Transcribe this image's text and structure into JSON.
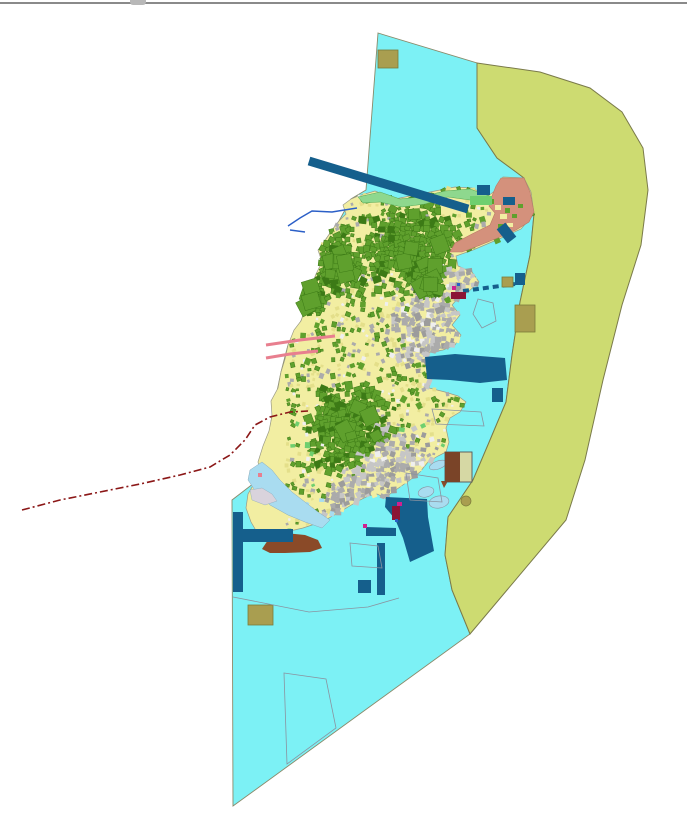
{
  "meta": {
    "title": "island-land-use-planning-map",
    "width": 687,
    "height": 821
  },
  "chrome": {
    "top_border_color": "#8a8a8a",
    "notch": {
      "x": 130,
      "w": 16,
      "color": "#b8b8b8"
    }
  },
  "palette": {
    "sea": "#7CF1F5",
    "sea_stroke": "#8a8a6a",
    "coastal_band": "#CDDB71",
    "band_stroke": "#7a7a4a",
    "island_base": "#F2EEA2",
    "island_stroke": "#9a9a86",
    "green": "#5FA02D",
    "green_dark": "#3C7A16",
    "green_light": "#6FCF6F",
    "beach": "#8ED88E",
    "beach_stroke": "#55A855",
    "urban": "#ABABAB",
    "urban_light": "#C6C6C6",
    "urban_dark": "#9C9C9C",
    "salmon": "#D4917C",
    "salmon_stroke": "#b97a64",
    "navy": "#155F8C",
    "khaki": "#A99E50",
    "khaki_stroke": "#7a7a3a",
    "brown": "#8A4A28",
    "pale_blue": "#A9DCF0",
    "pale_blue_stroke": "#88AABB",
    "pale_gray": "#D9D3DC",
    "outline": "#8A93A0",
    "boundary_red": "#8B1717",
    "pink": "#E87F8F",
    "stream_blue": "#2B5FC7",
    "magenta": "#D02090",
    "crimson": "#8B1535",
    "white_speck": "#EFEFEF",
    "yellow_deep": "#E4DF8A"
  },
  "geometry": {
    "sea": "378,33 477,63 477,128 497,158 516,172 524,178 534,214 530,255 520,302 512,355 506,402 490,440 473,480 448,517 445,555 452,590 461,612 470,634 233,806 232,500 262,477 272,416 281,372 288,345 301,321 305,310 311,287 322,262 326,239 339,221 351,199 366,190",
    "coastal_band": "477,63 540,72 590,88 622,112 643,148 648,190 641,245 622,305 603,380 585,460 566,520 470,634 461,612 452,590 445,555 448,517 473,480 490,440 506,402 512,355 520,302 530,255 534,214 524,178 516,172 497,158 477,128",
    "island": "358,196 375,191 395,199 415,195 435,191 455,187 472,188 488,196 496,190 503,177 524,178 531,192 534,214 521,229 499,239 473,250 456,256 458,266 472,272 479,282 468,292 459,297 452,305 460,315 452,325 461,335 455,345 443,350 430,352 427,362 432,375 429,388 445,392 458,396 466,402 460,412 450,418 446,428 449,442 446,452 438,456 428,462 420,472 410,480 400,487 390,494 386,498 377,494 368,496 358,501 348,507 338,513 327,519 315,524 303,528 290,531 277,534 266,540 258,534 251,522 246,508 248,494 255,482 262,477 258,462 263,446 269,431 272,416 271,401 278,388 281,372 285,359 288,345 294,330 301,321 305,310 303,295 311,287 316,274 322,262 318,250 326,239 332,230 339,221 346,214 343,205 351,199",
    "beach_strip": "358,197 380,192 400,199 420,197 445,191 470,189 492,197 488,203 470,200 448,197 425,204 402,207 380,202 363,203",
    "reclamation": "501,178 524,178 530,192 534,212 529,222 516,230 500,237 478,246 462,252 450,252 455,243 472,234 490,225 495,213 489,206 492,196 496,186",
    "harbor": "425,357 455,354 480,356 505,358 507,380 480,383 450,380 427,379",
    "pier_south": "386,497 427,499 428,517 434,551 410,562 403,538 395,519 385,507",
    "small_navy_bar": "366,527 396,528 396,536 366,536",
    "brown_blob": "262,549 270,537 285,533 305,535 318,540 322,548 310,552 285,553 270,553",
    "brown_triangle": "441,481 448,481 444,488",
    "lagoon": "250,470 262,462 272,470 280,480 292,492 305,502 318,512 330,520 322,528 305,522 288,515 270,505 256,492 248,480",
    "pale_gray_blob": "250,490 262,488 272,494 277,501 265,505 252,500",
    "outline_shapes": [
      {
        "name": "anchorage-pentagon",
        "points": "478,299 493,303 496,321 482,328 473,314"
      },
      {
        "name": "anchorage-quad-east",
        "points": "432,409 481,412 484,426 436,424"
      },
      {
        "name": "anchorage-quad-southeast",
        "points": "406,473 438,478 442,502 410,500"
      },
      {
        "name": "anchorage-quad-southwest",
        "points": "350,543 378,546 382,568 352,566"
      },
      {
        "name": "anchorage-quad-south",
        "points": "284,673 326,679 336,728 287,764"
      }
    ],
    "south_zone_polyline": "233,597 309,612 368,607 399,598",
    "zone_rects": [
      {
        "name": "zone-rect-north-khaki",
        "x": 378,
        "y": 50,
        "w": 20,
        "h": 18,
        "fill": "khaki",
        "stroke": "khaki_stroke"
      },
      {
        "name": "zone-rect-navy-north",
        "x": 477,
        "y": 185,
        "w": 13,
        "h": 10,
        "fill": "navy"
      },
      {
        "name": "zone-rect-green-north",
        "x": 470,
        "y": 196,
        "w": 22,
        "h": 9,
        "fill": "green_light"
      },
      {
        "name": "zone-blob-navy-salmon",
        "x": 503,
        "y": 197,
        "w": 12,
        "h": 8,
        "fill": "navy"
      },
      {
        "name": "zone-rect-khaki-east-small",
        "x": 502,
        "y": 277,
        "w": 11,
        "h": 10,
        "fill": "khaki",
        "stroke": "khaki_stroke"
      },
      {
        "name": "zone-rect-navy-east-small",
        "x": 515,
        "y": 273,
        "w": 10,
        "h": 12,
        "fill": "navy"
      },
      {
        "name": "zone-rect-khaki-east-large",
        "x": 515,
        "y": 305,
        "w": 20,
        "h": 27,
        "fill": "khaki",
        "stroke": "khaki_stroke"
      },
      {
        "name": "zone-rect-navy-southeast",
        "x": 492,
        "y": 388,
        "w": 11,
        "h": 14,
        "fill": "navy"
      },
      {
        "name": "zone-rect-navy-pier-bar",
        "x": 377,
        "y": 543,
        "w": 8,
        "h": 52,
        "fill": "navy"
      },
      {
        "name": "zone-rect-navy-south-square",
        "x": 358,
        "y": 580,
        "w": 13,
        "h": 13,
        "fill": "navy"
      },
      {
        "name": "zone-rect-navy-west-bar",
        "x": 233,
        "y": 512,
        "w": 10,
        "h": 80,
        "fill": "navy"
      },
      {
        "name": "zone-rect-navy-west-arm",
        "x": 243,
        "y": 529,
        "w": 50,
        "h": 13,
        "fill": "navy"
      },
      {
        "name": "zone-rect-khaki-southwest",
        "x": 248,
        "y": 605,
        "w": 25,
        "h": 20,
        "fill": "khaki",
        "stroke": "khaki_stroke"
      }
    ],
    "bordered_rect": {
      "x": 445,
      "y": 452,
      "w": 27,
      "h": 30,
      "left_w": 15
    },
    "khaki_circle": {
      "cx": 466,
      "cy": 501,
      "r": 5
    },
    "islets": [
      {
        "cx": 426,
        "cy": 492,
        "rx": 8,
        "ry": 5,
        "rot": -15
      },
      {
        "cx": 439,
        "cy": 502,
        "rx": 10,
        "ry": 6,
        "rot": -10
      },
      {
        "cx": 438,
        "cy": 465,
        "rx": 9,
        "ry": 4,
        "rot": -20
      }
    ],
    "lines": {
      "breakwater_main": {
        "x1": 309,
        "y1": 161,
        "x2": 468,
        "y2": 209,
        "w": 9
      },
      "breakwater_short": {
        "x1": 501,
        "y1": 226,
        "x2": 512,
        "y2": 240,
        "w": 11
      },
      "breakwater_dashes": {
        "x1": 463,
        "y1": 291,
        "x2": 515,
        "y2": 284,
        "w": 4,
        "dash": "6 4"
      },
      "pink_piers": [
        {
          "points": "266,345 300,340 335,336",
          "w": 3
        },
        {
          "points": "266,358 290,354 318,351",
          "w": 3
        }
      ],
      "streams": [
        {
          "points": "357,208 332,212 312,211 300,218 288,226",
          "w": 1.4
        },
        {
          "points": "290,230 305,232",
          "w": 1.4
        }
      ],
      "boundary_dashed": {
        "points": "22,510 60,500 100,492 140,484 180,475 210,467 230,455 245,440 255,425 270,417 290,412 308,411",
        "w": 1.6,
        "dash": "8 3 2 3"
      }
    },
    "micro_marks": [
      {
        "x": 392,
        "y": 506,
        "w": 8,
        "h": 14,
        "fill": "crimson"
      },
      {
        "x": 397,
        "y": 502,
        "w": 5,
        "h": 4,
        "fill": "magenta"
      },
      {
        "x": 395,
        "y": 519,
        "w": 3,
        "h": 3,
        "fill": "stream_blue"
      },
      {
        "x": 363,
        "y": 524,
        "w": 4,
        "h": 4,
        "fill": "magenta"
      },
      {
        "x": 451,
        "y": 292,
        "w": 15,
        "h": 7,
        "fill": "crimson"
      },
      {
        "x": 452,
        "y": 286,
        "w": 4,
        "h": 4,
        "fill": "magenta"
      },
      {
        "x": 457,
        "y": 283,
        "w": 3,
        "h": 3,
        "fill": "stream_blue"
      },
      {
        "x": 258,
        "y": 473,
        "w": 4,
        "h": 4,
        "fill": "pink"
      }
    ],
    "salmon_speckles": [
      {
        "x": 495,
        "y": 205,
        "w": 6,
        "h": 5,
        "fill": "island_base"
      },
      {
        "x": 500,
        "y": 214,
        "w": 7,
        "h": 5,
        "fill": "island_base"
      },
      {
        "x": 505,
        "y": 208,
        "w": 5,
        "h": 5,
        "fill": "green"
      },
      {
        "x": 512,
        "y": 214,
        "w": 5,
        "h": 4,
        "fill": "green"
      },
      {
        "x": 498,
        "y": 224,
        "w": 5,
        "h": 4,
        "fill": "green"
      },
      {
        "x": 518,
        "y": 204,
        "w": 5,
        "h": 4,
        "fill": "green"
      },
      {
        "x": 507,
        "y": 223,
        "w": 6,
        "h": 4,
        "fill": "island_base"
      },
      {
        "x": 488,
        "y": 199,
        "w": 6,
        "h": 5,
        "fill": "green"
      }
    ],
    "texture": {
      "seed": 1337,
      "cell": 5,
      "bbox": [
        288,
        175,
        540,
        562
      ],
      "green_clusters": [
        [
          412,
          248,
          52
        ],
        [
          338,
          264,
          36
        ],
        [
          350,
          428,
          48
        ],
        [
          310,
          300,
          20
        ],
        [
          430,
          285,
          16
        ]
      ],
      "urban_clusters": [
        [
          432,
          332,
          48
        ],
        [
          396,
          478,
          55
        ],
        [
          350,
          505,
          28
        ],
        [
          465,
          285,
          26
        ],
        [
          452,
          330,
          24
        ]
      ],
      "salmon_speckle_region": [
        360,
        470,
        208,
        245
      ]
    }
  }
}
